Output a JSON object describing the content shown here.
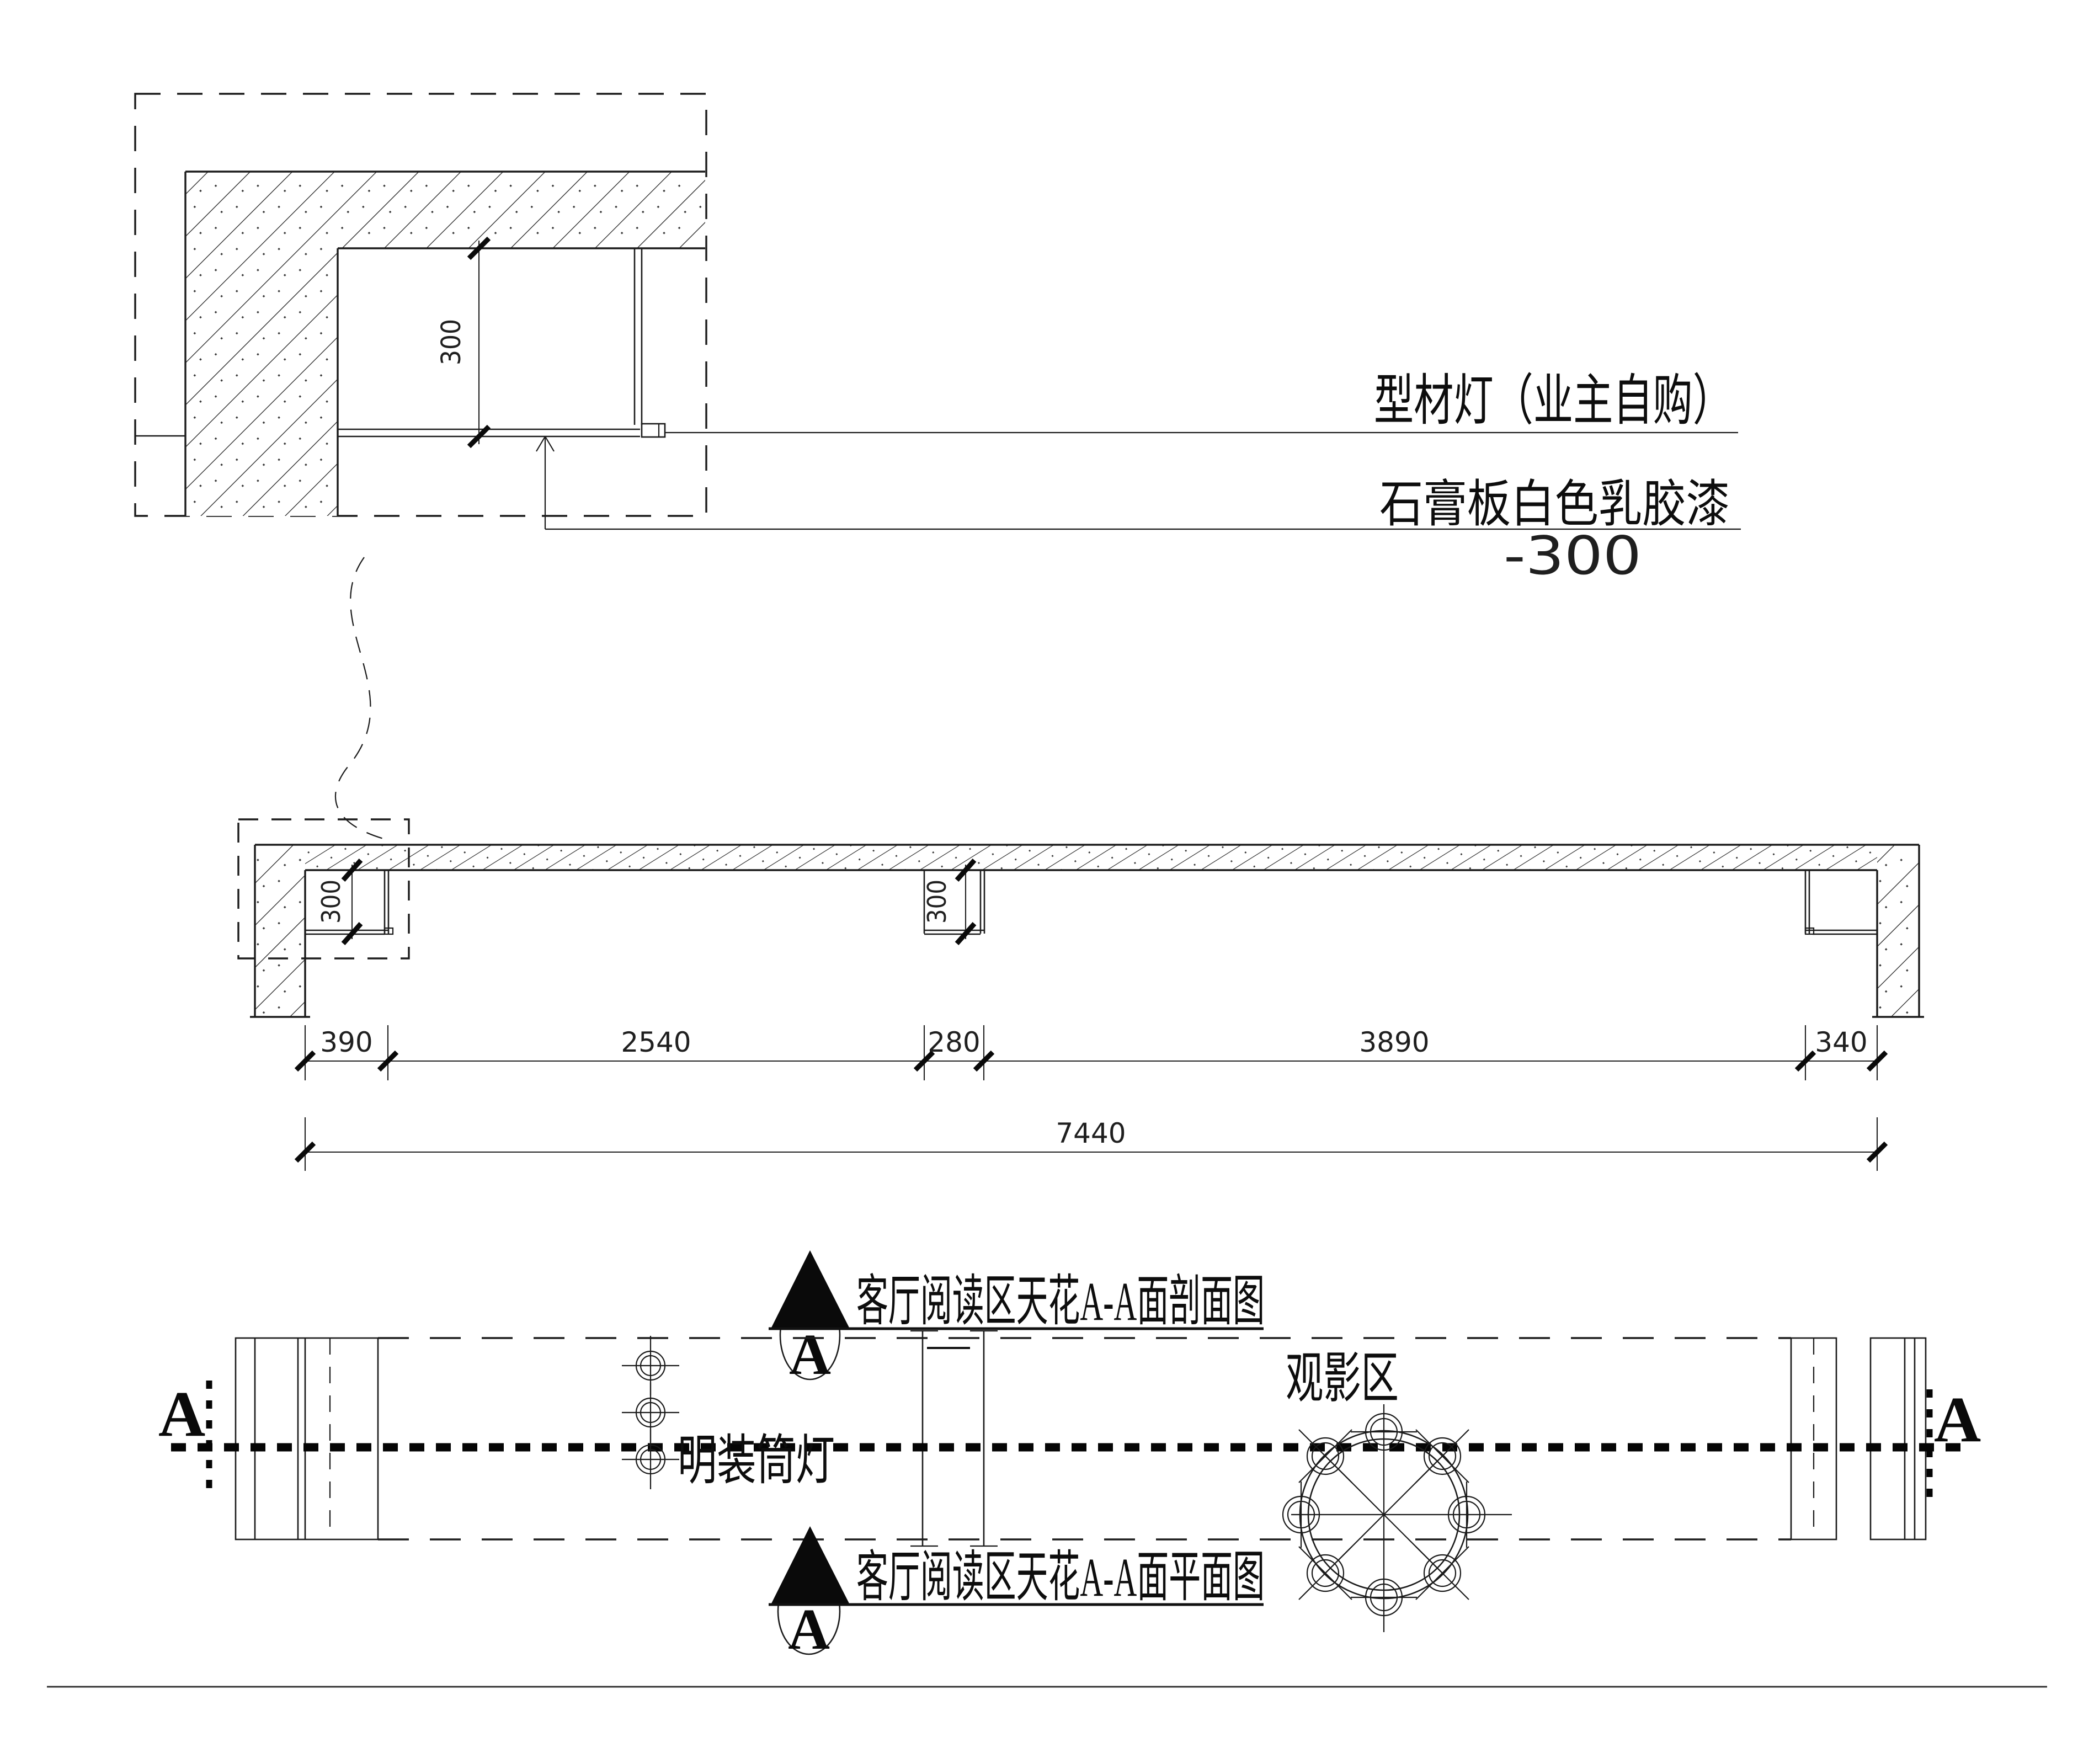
{
  "drawing": {
    "type": "ceiling-construction-detail",
    "line_color": "#1b1b1b",
    "background": "#ffffff"
  },
  "detail_callout": {
    "recess_depth_dim": "300",
    "label_profile_light": "型材灯（业主自购）",
    "label_gypsum_paint": "石膏板白色乳胶漆",
    "label_level": "-300"
  },
  "section_view": {
    "title": "客厅阅读区天花A-A面剖面图",
    "marker_letter": "A",
    "recess1_depth_dim": "300",
    "recess2_depth_dim": "300",
    "dims_row1": [
      "390",
      "2540",
      "280",
      "3890",
      "340"
    ],
    "dim_total": "7440"
  },
  "plan_view": {
    "title": "客厅阅读区天花A-A面平面图",
    "marker_letter": "A",
    "section_letter_left": "A",
    "section_letter_right": "A",
    "zone_label": "观影区",
    "downlight_label": "明装筒灯"
  }
}
